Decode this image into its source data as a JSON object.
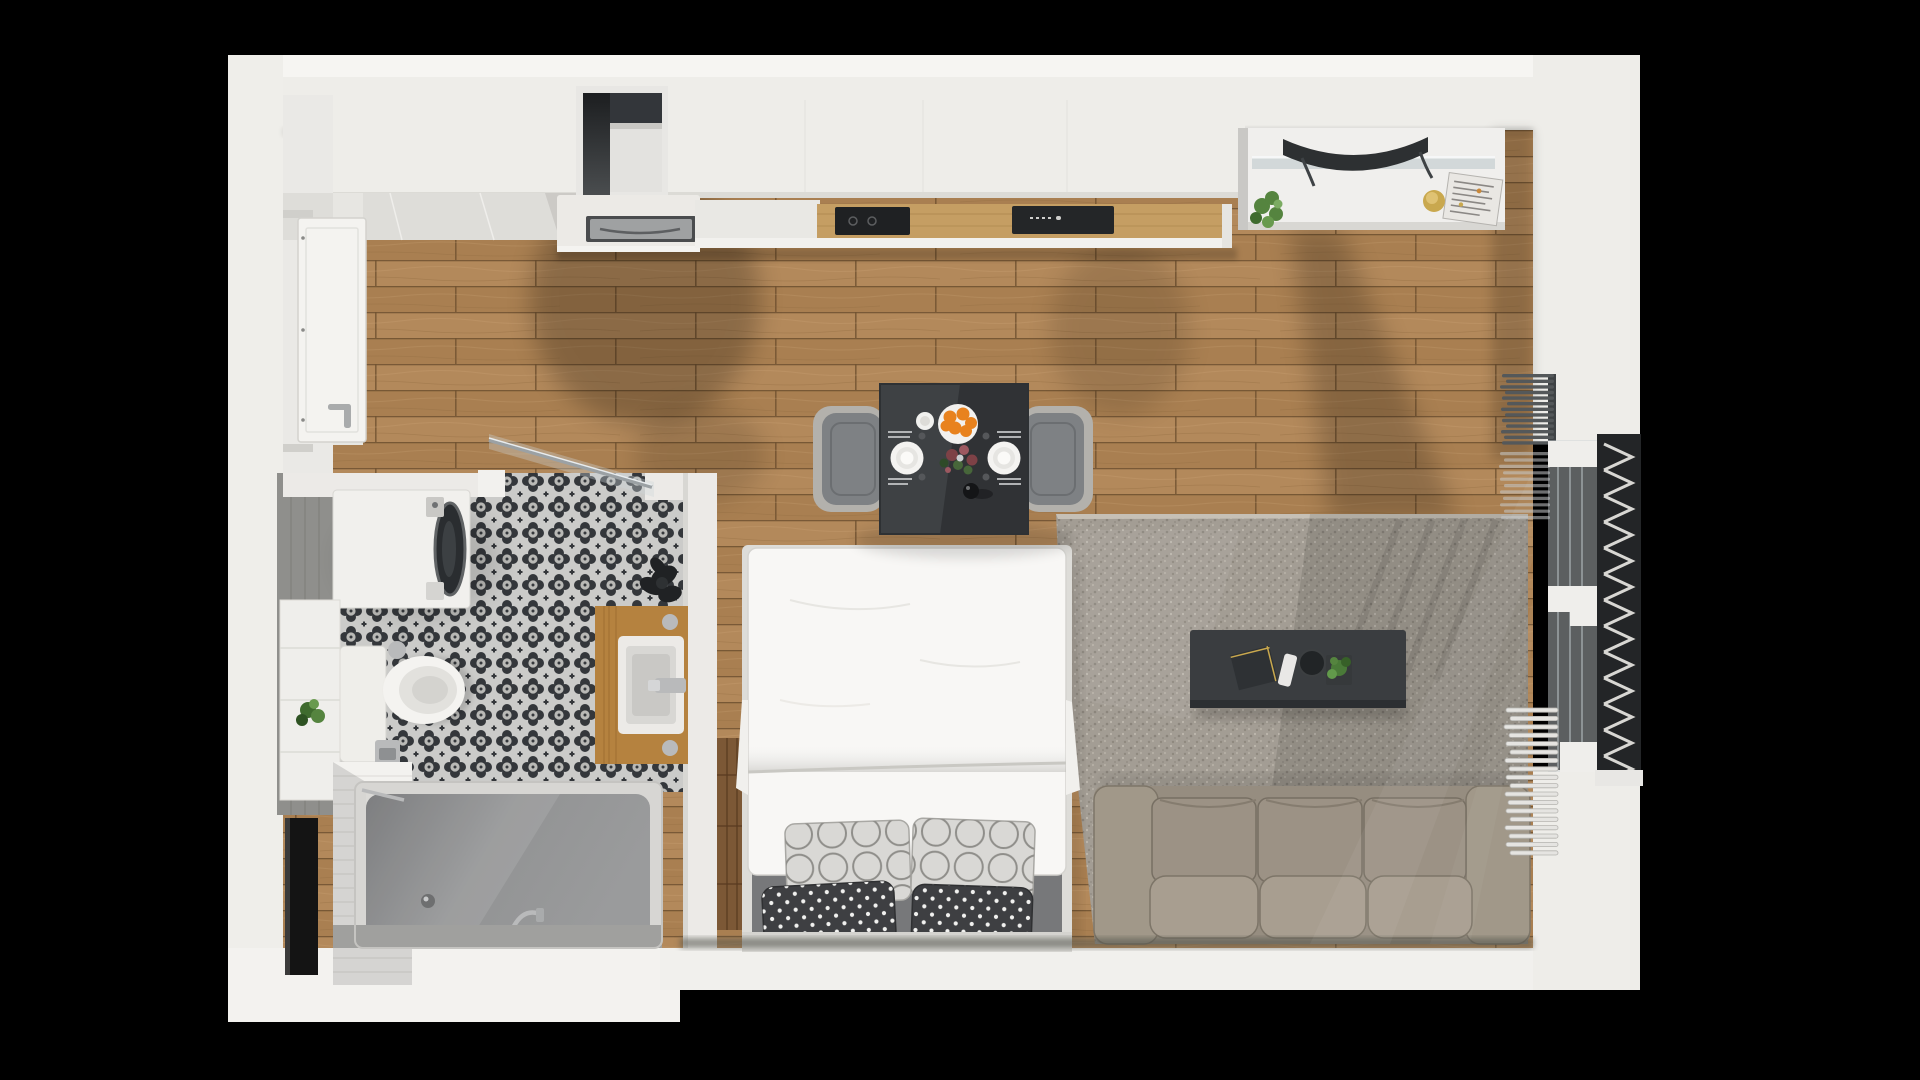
{
  "scene": {
    "title": "studio-apartment-top-down-3d-render",
    "view": "top-down",
    "width": 1920,
    "height": 1080
  },
  "colors": {
    "background": "#000000",
    "wall": "#eeede9",
    "wallBright": "#f6f5f2",
    "wallShade": "#dcdbd6",
    "woodBase": "#b3895b",
    "woodAlt": "#a97f51",
    "woodSeam": "#6f5130",
    "woodGrain": "#c7a171",
    "entryTile": "#deddd9",
    "counterWhite": "#e9e8e4",
    "counterWood": "#c59e63",
    "applianceBlack": "#1f2123",
    "sinkSteel": "#9fa1a2",
    "chrome": "#b9babb",
    "tileLight": "#cbcbc9",
    "tileDark": "#34373b",
    "grayWallTile": "#8f8f8c",
    "subwayWhite": "#f3f2ef",
    "tubRim": "#d7d6d3",
    "tubGray": "#909192",
    "vanityWood": "#b5823f",
    "plantGreen": "#55843f",
    "plantDark": "#202224",
    "tableDark": "#3e4144",
    "coffeeTableDark": "#3a3d40",
    "chairGray": "#7e8184",
    "chairEdge": "#b3b1ac",
    "rugBase": "#a39d94",
    "sofaBase": "#968d80",
    "sofaCushion": "#9c9285",
    "sofaBack": "#a89e90",
    "bedWhite": "#f8f7f5",
    "bedFrame": "#dddcd8",
    "headboard": "#77787a",
    "pillowLight": "#d9d8d5",
    "pillowRing": "#8f8e8a",
    "pillowDark": "#3e3f42",
    "woodPanel": "#7c5836",
    "radiatorDark": "#54585a",
    "radiatorWhite": "#e5e4e1",
    "glassBlue": "#ccd3d5",
    "latticeDark": "#232527",
    "latticeLight": "#d8d7d3",
    "orange": "#e8821e",
    "gold": "#c9a84e",
    "magazine": "#e9e7e3",
    "bottleDark": "#141517"
  },
  "rooms": [
    {
      "name": "entry-hall"
    },
    {
      "name": "bathroom"
    },
    {
      "name": "kitchen"
    },
    {
      "name": "living-sleeping-area"
    },
    {
      "name": "balcony-edge"
    }
  ],
  "objects": [
    "entry-door",
    "wardrobe-wall",
    "window-niche",
    "kitchen-upper-cabinets",
    "kitchen-sink",
    "kitchen-counter",
    "cooktop",
    "built-in-oven",
    "media-sideboard",
    "tv",
    "glass-shelf",
    "magazine",
    "candle",
    "kitchen-plant",
    "dining-table",
    "dining-chair-left",
    "dining-chair-right",
    "dinner-plate-left",
    "dinner-plate-right",
    "fruit-plate-oranges",
    "espresso-cup",
    "flower-centerpiece",
    "wine-bottle",
    "cutlery",
    "double-bed",
    "duvet",
    "circle-pattern-pillow-left",
    "circle-pattern-pillow-right",
    "polka-dot-pillow-left",
    "polka-dot-pillow-right",
    "wood-panel-strip",
    "area-rug",
    "coffee-table",
    "book",
    "remote-control",
    "serving-tray",
    "coffee-table-plant",
    "sofa",
    "radiator-upper",
    "radiator-glass",
    "towel-radiator",
    "balcony-door",
    "balcony-lattice",
    "washing-machine",
    "toilet",
    "toilet-paper-holder",
    "bathtub",
    "tub-faucet",
    "tub-drain",
    "vanity-counter",
    "vanity-sink",
    "vanity-faucet",
    "dark-plant",
    "storage-column",
    "storage-plant",
    "black-niche",
    "shower-glass-door",
    "patterned-tile-floor",
    "gray-tile-wall",
    "subway-tile-wall",
    "wood-floor",
    "entry-tile-floor"
  ]
}
